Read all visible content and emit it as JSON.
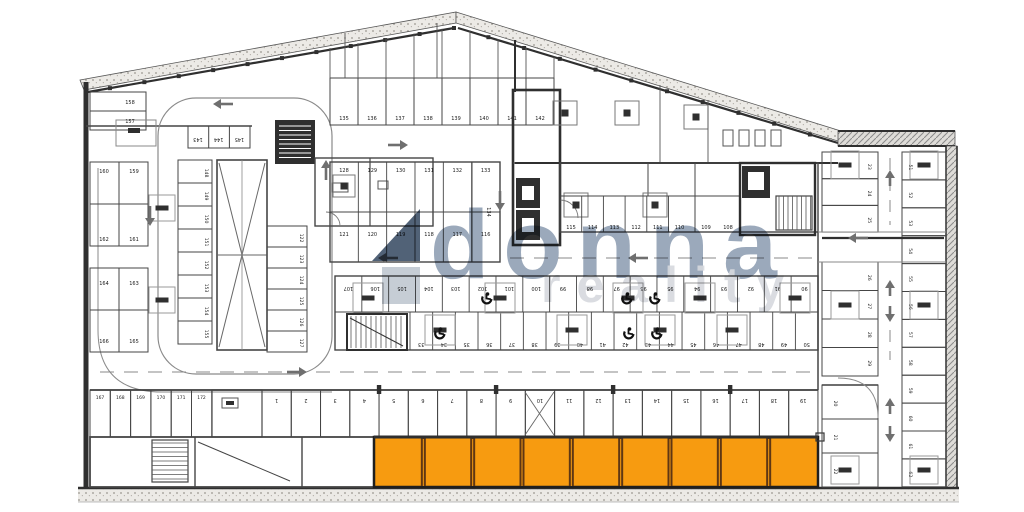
{
  "title": "Parking garage floor plan",
  "watermark": {
    "brand": "donna",
    "brand_sub": "reality",
    "brand_color": "#8394ab",
    "sub_color": "#d6d9de",
    "logo_dark": "#3e5168",
    "logo_light": "#b8c1cb"
  },
  "colors": {
    "highlight_fill": "#F79B10",
    "highlight_divider": "#5f3713",
    "wall_dark": "#2f2f2f",
    "line": "#454545",
    "light_line": "#8a8a8a",
    "arrow": "#6f6f6f",
    "speckle": "#9a968f",
    "band_fill": "#eceae6",
    "number": "#1a1a1a"
  },
  "highlighted_stalls": {
    "count": 9,
    "meaning": "highlighted parking spaces"
  },
  "stall_rows": {
    "top": [
      "135",
      "136",
      "137",
      "138",
      "139",
      "140",
      "141",
      "142"
    ],
    "mid_upper": [
      "128",
      "129",
      "130",
      "131",
      "132",
      "133"
    ],
    "mid_lower": [
      "121",
      "120",
      "119",
      "118",
      "117",
      "116"
    ],
    "mid_end_cell": "134",
    "right_mid": [
      "115",
      "114",
      "113",
      "112",
      "111",
      "110"
    ],
    "right_mid2": [
      "109",
      "108"
    ],
    "center_upper": [
      "107",
      "106",
      "105",
      "104",
      "103",
      "102",
      "101",
      "100",
      "99",
      "98",
      "97",
      "96",
      "95",
      "94",
      "93",
      "92",
      "91",
      "90"
    ],
    "center_lower": [
      "33",
      "34",
      "35",
      "36",
      "37",
      "38",
      "39",
      "40",
      "41",
      "42",
      "43",
      "44",
      "45",
      "46",
      "47",
      "48",
      "49",
      "50"
    ],
    "left_top_block": [
      "158",
      "157"
    ],
    "left_block_a": [
      "160",
      "159",
      "162",
      "161"
    ],
    "left_block_b": [
      "164",
      "163",
      "166",
      "165"
    ],
    "left_cells": [
      "148",
      "149",
      "150",
      "151",
      "152",
      "153",
      "154",
      "155"
    ],
    "spine_cells": [
      "122",
      "123",
      "124",
      "125",
      "126",
      "127"
    ],
    "top_left_cells": [
      "143",
      "144",
      "145"
    ],
    "bottom_left_cells": [
      "167",
      "168",
      "169",
      "170",
      "171",
      "172"
    ],
    "bottom_cells": [
      "1",
      "2",
      "3",
      "4",
      "5",
      "6",
      "7",
      "8",
      "9",
      "10",
      "11",
      "12",
      "13",
      "14",
      "15",
      "16",
      "17",
      "18",
      "19"
    ],
    "right_inner_upper": [
      "23",
      "24",
      "25"
    ],
    "right_inner_mid": [
      "26",
      "27",
      "28",
      "29"
    ],
    "right_inner_lower": [
      "20",
      "21",
      "22"
    ],
    "right_outer": [
      "51",
      "52",
      "53",
      "54",
      "55",
      "56",
      "57",
      "58",
      "59",
      "60",
      "61",
      "62"
    ]
  }
}
